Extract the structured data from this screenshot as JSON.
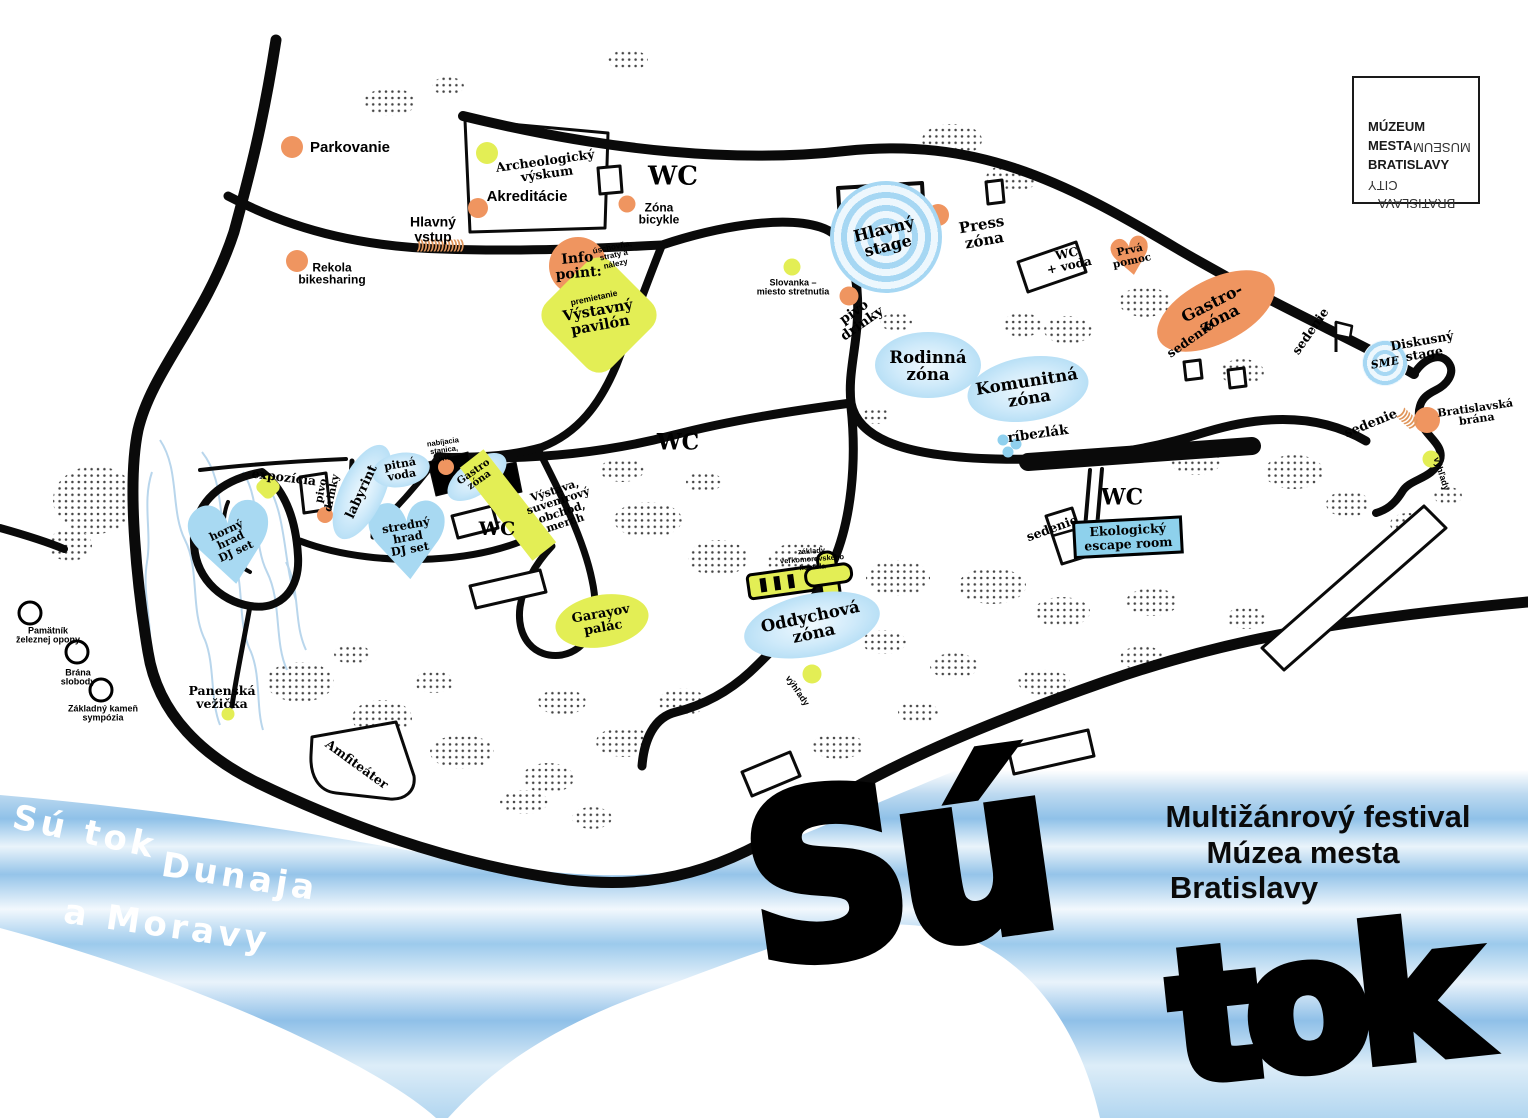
{
  "logo": {
    "l1": "MÚZEUM",
    "l2a": "MESTA",
    "l2b": "MUSEUM",
    "l3a": "BRATISLAVY",
    "l3b": "CITY",
    "l4": "BRATISLAVA"
  },
  "wordmark": {
    "p1": "Sú",
    "p2": "tok"
  },
  "subtitle": {
    "l1": "Multižánrový festival",
    "l2": "Múzea mesta",
    "l3": "Bratislavy"
  },
  "river": {
    "p1": "Sú tok",
    "p2": "Dunaja",
    "p3": "a Moravy"
  },
  "decor": {
    "entrance_arrows": "))))))))))))))",
    "gate_arrows": "))))))",
    "heart_glyph": "♥"
  },
  "labels": {
    "parkovanie": "Parkovanie",
    "rekola": "Rekola\nbikesharing",
    "hlavny_vstup": "Hlavný\nvstup",
    "akreditacie": "Akreditácie",
    "archeologicky": "Archeologický\nvýskum",
    "zona_bicykle": "Zóna\nbicykle",
    "wc_top": "WC",
    "info_point": "Info\npoint:",
    "uschovna": "úschovňa,\nstraty a\nnálezy",
    "premietanie": "premietanie",
    "vystavny_pavilon": "Výstavný\npavilón",
    "slovanka": "Slovanka –\nmiesto stretnutia",
    "hlavny_stage": "Hlavný\nstage",
    "press_zona": "Press\nzóna",
    "pivo_drinky_a": "pivo\ndrinky",
    "wc_voda": "WC\n+ voda",
    "prva_pomoc": "Prvá\npomoc",
    "gastro_zona": "Gastro-\nzóna",
    "sedenie_a": "sedenie",
    "sedenie_b": "sedenie",
    "sedenie_c": "sedenie",
    "sedenie_d": "sedenie",
    "diskusny_stage": "Diskusný\nstage",
    "sme": "SME",
    "bratislavska_brana": "Bratislavská\nbrána",
    "vyhlady_a": "výhľady",
    "vyhlady_b": "výhľady",
    "rodinna_zona": "Rodinná\nzóna",
    "komunitna_zona": "Komunitná\nzóna",
    "ribezlak": "ríbezlák",
    "wc_center": "WC",
    "expozicia": "expozícia",
    "pivo_drinky_b": "pivo\ndrinky",
    "labyrint": "labyrint",
    "pitna_voda": "pitná\nvoda",
    "horny_hrad": "horný\nhrad\nDJ set",
    "stredny_hrad": "stredný\nhrad\nDJ set",
    "nabijacia": "nabíjacia\nstanica,\nwifi",
    "gastro_zona_hrad": "Gastro\nzóna",
    "vystava": "Výstava,\nsuvenírový\nobchod,\nmerch",
    "wc_hrad": "WC",
    "garayov_palac": "Garayov\npalác",
    "zaklady_kostola": "základy\nveľkomoravského\nkostola",
    "oddychova_zona": "Oddychová\nzóna",
    "wc_vychod": "WC",
    "ekologicky_escape": "Ekologický\nescape room",
    "pamatnik": "Pamätník\nželeznej opony",
    "brana_slobody": "Brána\nslobody",
    "zakladny_kamen": "Základný kameň\nsympózia",
    "panenska_vezicka": "Panenská\nvežička",
    "amfiteater": "Amfiteáter"
  }
}
